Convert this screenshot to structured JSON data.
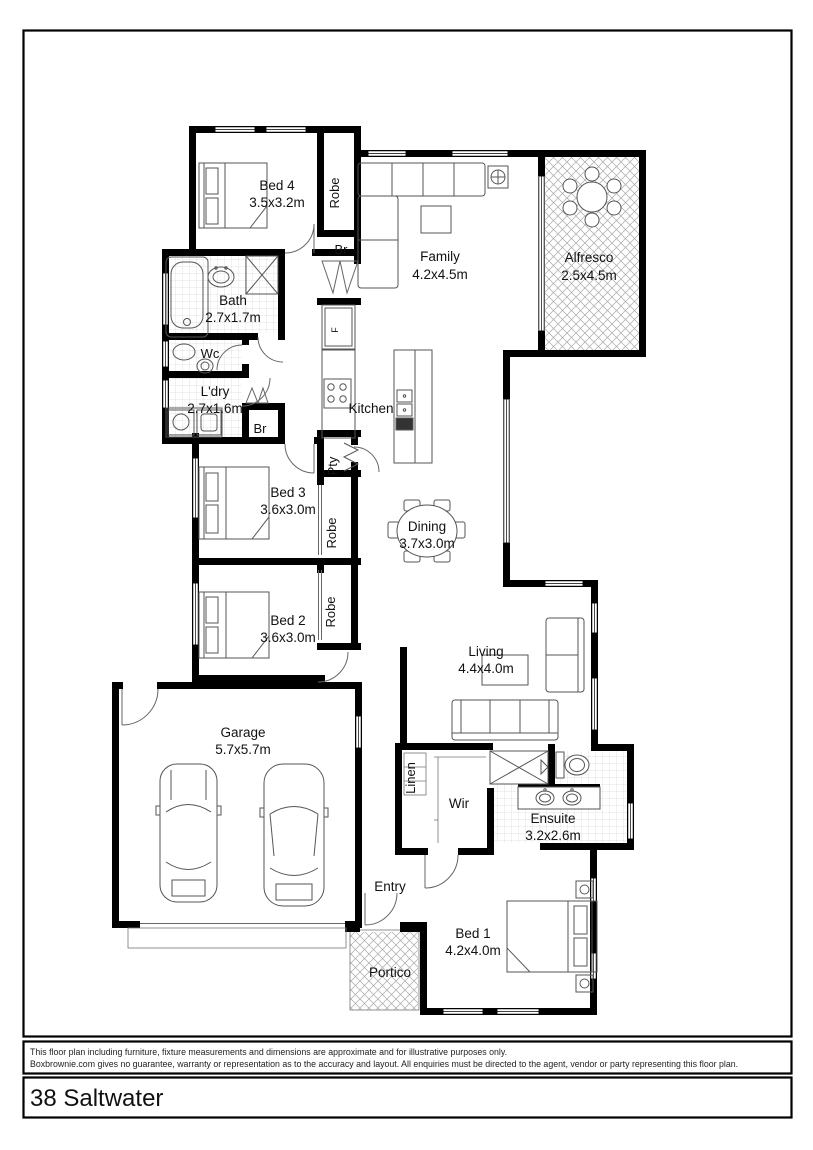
{
  "rooms": {
    "bed4": {
      "name": "Bed 4",
      "dims": "3.5x3.2m"
    },
    "robe4": {
      "name": "Robe"
    },
    "br4": {
      "name": "Br"
    },
    "family": {
      "name": "Family",
      "dims": "4.2x4.5m"
    },
    "alfresco": {
      "name": "Alfresco",
      "dims": "2.5x4.5m"
    },
    "bath": {
      "name": "Bath",
      "dims": "2.7x1.7m"
    },
    "wc": {
      "name": "Wc"
    },
    "ldry": {
      "name": "L'dry",
      "dims": "2.7x1.6m"
    },
    "br2": {
      "name": "Br"
    },
    "kitchen": {
      "name": "Kitchen"
    },
    "pty": {
      "name": "Pty"
    },
    "bed3": {
      "name": "Bed 3",
      "dims": "3.6x3.0m"
    },
    "robe3": {
      "name": "Robe"
    },
    "bed2": {
      "name": "Bed 2",
      "dims": "3.6x3.0m"
    },
    "robe2": {
      "name": "Robe"
    },
    "dining": {
      "name": "Dining",
      "dims": "3.7x3.0m"
    },
    "living": {
      "name": "Living",
      "dims": "4.4x4.0m"
    },
    "garage": {
      "name": "Garage",
      "dims": "5.7x5.7m"
    },
    "linen": {
      "name": "Linen"
    },
    "wir": {
      "name": "Wir"
    },
    "ensuite": {
      "name": "Ensuite",
      "dims": "3.2x2.6m"
    },
    "entry": {
      "name": "Entry"
    },
    "bed1": {
      "name": "Bed 1",
      "dims": "4.2x4.0m"
    },
    "portico": {
      "name": "Portico"
    },
    "fridge_label": "F"
  },
  "footer": {
    "disclaimer_line1": "This floor plan including furniture, fixture measurements and dimensions are approximate and for illustrative purposes only.",
    "disclaimer_line2": "Boxbrownie.com gives no guarantee, warranty or representation as to the accuracy and layout. All enquiries must be directed to the agent, vendor or party representing this floor plan.",
    "title": "38 Saltwater"
  },
  "colors": {
    "wall": "#000000",
    "paper": "#ffffff",
    "hatch": "#aaaaaa",
    "tile": "#c8c8c8"
  }
}
